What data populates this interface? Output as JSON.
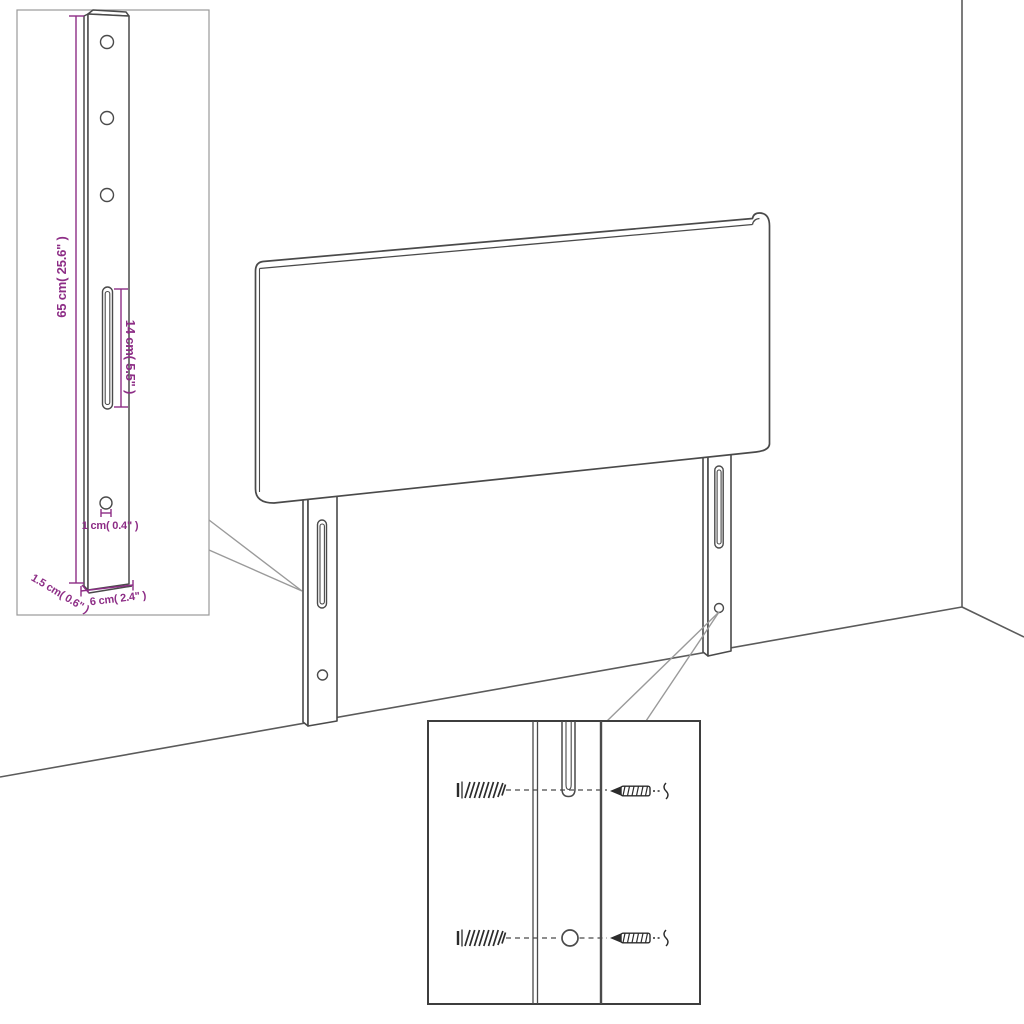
{
  "colors": {
    "line": "#4a4a4a",
    "room_line": "#5b5b5b",
    "callout_line": "#9a9a9a",
    "detail_box_light_border": "#999999",
    "detail_box_dark_border": "#3e3e3e",
    "hardware": "#2c2c2c",
    "dimension": "#8d2d86",
    "background": "#ffffff"
  },
  "diagram": {
    "subject": "headboard-with-mounting-legs",
    "labels": {
      "height": "65 cm( 25.6\" )",
      "slot": "14 cm( 5.5\" )",
      "hole": "1 cm( 0.4\" )",
      "thickness": "1.5 cm( 0.6\" )",
      "width": "6 cm( 2.4\" )"
    }
  }
}
